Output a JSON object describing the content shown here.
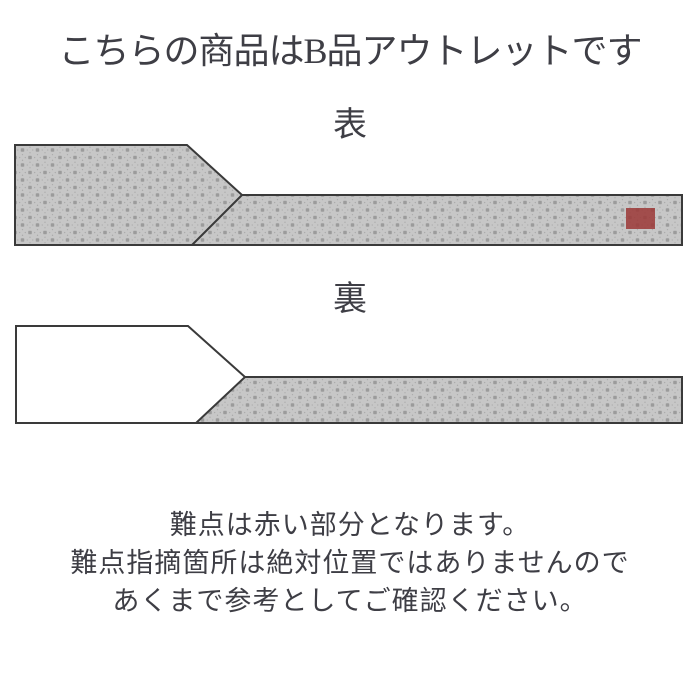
{
  "page": {
    "title": "こちらの商品はB品アウトレットです",
    "background": "#ffffff"
  },
  "diagrams": {
    "front": {
      "label": "表",
      "has_defect_marker": true
    },
    "back": {
      "label": "裏",
      "has_defect_marker": false
    }
  },
  "note": {
    "lines": [
      "難点は赤い部分となります。",
      "難点指摘箇所は絶対位置ではありませんので",
      "あくまで参考としてご確認ください。"
    ]
  },
  "colors": {
    "text": "#3e3e45",
    "outline": "#3a3a3a",
    "pattern_base": "#9b9b9b",
    "pattern_ring": "#c7c7c7",
    "lining_white": "#ffffff",
    "defect_red": "#9c3b39"
  }
}
